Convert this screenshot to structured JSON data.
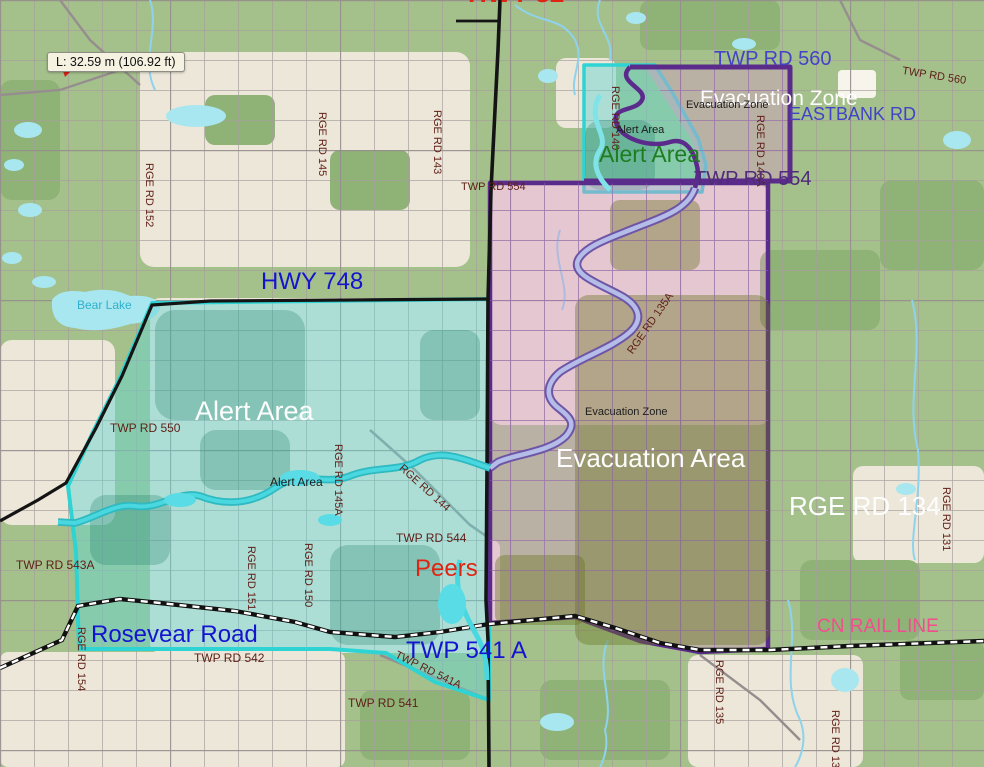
{
  "map": {
    "measurement_tooltip": "L: 32.59 m (106.92 ft)",
    "colors": {
      "blue": "#1414cf",
      "indigo": "#4343c6",
      "maroon": "#5e1d16",
      "red": "#e02413",
      "white": "#fdfdfd",
      "black": "#1c1c1c",
      "green": "#1e7d1e",
      "purple": "#4f2d79",
      "pink": "#f04f8c",
      "lake": "#2fb0cc",
      "alert_border": "#2ed3d3",
      "evacuation_border": "#5b2b8c",
      "rail": "#111111"
    },
    "zones": [
      {
        "name": "Alert Area",
        "style": "cyan"
      },
      {
        "name": "Evacuation Area",
        "style": "purple-pink"
      },
      {
        "name": "Evacuation Zone",
        "style": "purple-pink"
      }
    ],
    "labels": [
      {
        "text": "HWY 32",
        "x": 468,
        "y": -20,
        "size": 26,
        "color": "red",
        "bold": true
      },
      {
        "text": "TWP RD 560",
        "x": 714,
        "y": 49,
        "size": 20,
        "color": "indigo"
      },
      {
        "text": "TWP RD 560",
        "x": 903,
        "y": 66,
        "size": 11,
        "color": "maroon",
        "rotate": 9
      },
      {
        "text": "Evacuation Zone",
        "x": 700,
        "y": 88,
        "size": 21,
        "color": "white"
      },
      {
        "text": "Evacuation Zone",
        "x": 686,
        "y": 100,
        "size": 11,
        "color": "black"
      },
      {
        "text": "EASTBANK RD",
        "x": 789,
        "y": 105,
        "size": 18,
        "color": "indigo"
      },
      {
        "text": "RGE RD 140",
        "x": 620,
        "y": 86,
        "size": 11,
        "color": "maroon",
        "rotate": 90
      },
      {
        "text": "RGE RD 140A",
        "x": 765,
        "y": 115,
        "size": 11,
        "color": "maroon",
        "rotate": 90
      },
      {
        "text": "Alert Area",
        "x": 616,
        "y": 125,
        "size": 11,
        "color": "black"
      },
      {
        "text": "Alert Area",
        "x": 599,
        "y": 142,
        "size": 23,
        "color": "green"
      },
      {
        "text": "TWP RD 554",
        "x": 694,
        "y": 169,
        "size": 20,
        "color": "purple"
      },
      {
        "text": "TWP RD 554",
        "x": 461,
        "y": 182,
        "size": 11,
        "color": "maroon"
      },
      {
        "text": "RGE RD 152",
        "x": 154,
        "y": 163,
        "size": 11,
        "color": "maroon",
        "rotate": 90
      },
      {
        "text": "RGE RD 145",
        "x": 327,
        "y": 112,
        "size": 11,
        "color": "maroon",
        "rotate": 90
      },
      {
        "text": "RGE RD 143",
        "x": 442,
        "y": 110,
        "size": 11,
        "color": "maroon",
        "rotate": 90
      },
      {
        "text": "Bear Lake",
        "x": 77,
        "y": 299,
        "size": 12,
        "color": "lake"
      },
      {
        "text": "HWY 748",
        "x": 261,
        "y": 269,
        "size": 24,
        "color": "blue"
      },
      {
        "text": "TWP RD 550",
        "x": 110,
        "y": 422,
        "size": 12,
        "color": "maroon"
      },
      {
        "text": "Alert Area",
        "x": 195,
        "y": 397,
        "size": 27,
        "color": "white"
      },
      {
        "text": "Alert Area",
        "x": 270,
        "y": 476,
        "size": 12,
        "color": "black"
      },
      {
        "text": "RGE RD 145A",
        "x": 343,
        "y": 444,
        "size": 11,
        "color": "maroon",
        "rotate": 90
      },
      {
        "text": "RGE RD 144",
        "x": 404,
        "y": 463,
        "size": 11,
        "color": "maroon",
        "rotate": 42
      },
      {
        "text": "TWP RD 544",
        "x": 396,
        "y": 532,
        "size": 12,
        "color": "maroon"
      },
      {
        "text": "Peers",
        "x": 415,
        "y": 556,
        "size": 24,
        "color": "red"
      },
      {
        "text": "Evacuation Zone",
        "x": 585,
        "y": 407,
        "size": 11,
        "color": "black"
      },
      {
        "text": "Evacuation Area",
        "x": 556,
        "y": 445,
        "size": 26,
        "color": "white"
      },
      {
        "text": "RGE RD 135A",
        "x": 626,
        "y": 350,
        "size": 11,
        "color": "maroon",
        "rotate": -55
      },
      {
        "text": "RGE RD 134",
        "x": 789,
        "y": 493,
        "size": 26,
        "color": "white"
      },
      {
        "text": "RGE RD 131",
        "x": 951,
        "y": 487,
        "size": 11,
        "color": "maroon",
        "rotate": 90
      },
      {
        "text": "TWP RD 543A",
        "x": 16,
        "y": 559,
        "size": 12,
        "color": "maroon"
      },
      {
        "text": "RGE RD 151",
        "x": 256,
        "y": 546,
        "size": 11,
        "color": "maroon",
        "rotate": 90
      },
      {
        "text": "RGE RD 150",
        "x": 313,
        "y": 543,
        "size": 11,
        "color": "maroon",
        "rotate": 90
      },
      {
        "text": "Rosevear Road",
        "x": 91,
        "y": 622,
        "size": 24,
        "color": "blue"
      },
      {
        "text": "TWP RD 542",
        "x": 194,
        "y": 652,
        "size": 12,
        "color": "maroon"
      },
      {
        "text": "RGE RD 154",
        "x": 86,
        "y": 627,
        "size": 11,
        "color": "maroon",
        "rotate": 90
      },
      {
        "text": "TWP 541 A",
        "x": 406,
        "y": 638,
        "size": 24,
        "color": "blue"
      },
      {
        "text": "TWP RD 541A",
        "x": 398,
        "y": 650,
        "size": 11,
        "color": "maroon",
        "rotate": 26
      },
      {
        "text": "TWP RD 541",
        "x": 348,
        "y": 697,
        "size": 12,
        "color": "maroon"
      },
      {
        "text": "CN RAIL LINE",
        "x": 817,
        "y": 617,
        "size": 19,
        "color": "pink"
      },
      {
        "text": "RGE RD 135",
        "x": 724,
        "y": 660,
        "size": 11,
        "color": "maroon",
        "rotate": 90
      },
      {
        "text": "RGE RD 134",
        "x": 840,
        "y": 710,
        "size": 11,
        "color": "maroon",
        "rotate": 90
      }
    ]
  }
}
